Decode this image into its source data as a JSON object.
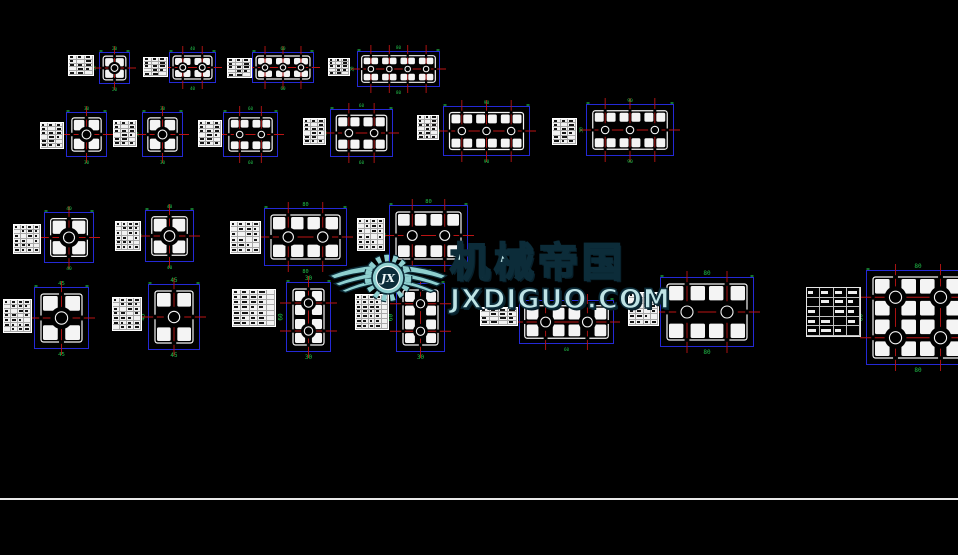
{
  "canvas": {
    "width": 958,
    "height": 555,
    "background": "#000000"
  },
  "palette": {
    "outline": "#f4f4f4",
    "dimension": "#2429d6",
    "centerline": "#bb1414",
    "annotation": "#21c04a",
    "table_bg": "#f2f2f2",
    "table_text": "#141414",
    "divider": "#e9e9e9"
  },
  "watermark": {
    "brand": "机械帝国",
    "site": "JXDIGUO.COM",
    "monogram": "JX",
    "fill": "#8ecfcf",
    "edge": "#0c2c39"
  },
  "divider": {
    "y": 498
  },
  "units": [
    {
      "name": "20x20",
      "dims": {
        "w": "20",
        "h": "20"
      },
      "table": {
        "x": 68,
        "y": 55,
        "w": 26,
        "h": 21,
        "rows": 5,
        "cols": 3
      },
      "draw": {
        "x": 99,
        "y": 52,
        "w": 31,
        "h": 32,
        "nx": 1,
        "ny": 1
      }
    },
    {
      "name": "20x40",
      "dims": {
        "w": "40",
        "h": "20"
      },
      "table": {
        "x": 143,
        "y": 57,
        "w": 25,
        "h": 20,
        "rows": 5,
        "cols": 3
      },
      "draw": {
        "x": 169,
        "y": 52,
        "w": 47,
        "h": 31,
        "nx": 2,
        "ny": 1
      }
    },
    {
      "name": "20x60",
      "dims": {
        "w": "60",
        "h": "20"
      },
      "table": {
        "x": 227,
        "y": 58,
        "w": 25,
        "h": 20,
        "rows": 5,
        "cols": 3
      },
      "draw": {
        "x": 252,
        "y": 52,
        "w": 62,
        "h": 31,
        "nx": 3,
        "ny": 1
      }
    },
    {
      "name": "20x80",
      "dims": {
        "w": "80",
        "h": "20"
      },
      "table": {
        "x": 328,
        "y": 58,
        "w": 22,
        "h": 18,
        "rows": 5,
        "cols": 3
      },
      "draw": {
        "x": 357,
        "y": 51,
        "w": 83,
        "h": 36,
        "nx": 4,
        "ny": 1
      }
    },
    {
      "name": "30x30-a",
      "dims": {
        "w": "30",
        "h": "30"
      },
      "table": {
        "x": 40,
        "y": 122,
        "w": 24,
        "h": 27,
        "rows": 6,
        "cols": 3
      },
      "draw": {
        "x": 66,
        "y": 112,
        "w": 41,
        "h": 45,
        "nx": 1,
        "ny": 1
      }
    },
    {
      "name": "30x30-b",
      "dims": {
        "w": "30",
        "h": "30"
      },
      "table": {
        "x": 113,
        "y": 120,
        "w": 24,
        "h": 27,
        "rows": 6,
        "cols": 3
      },
      "draw": {
        "x": 142,
        "y": 112,
        "w": 41,
        "h": 45,
        "nx": 1,
        "ny": 1
      }
    },
    {
      "name": "30x60-a",
      "dims": {
        "w": "60",
        "h": "30"
      },
      "table": {
        "x": 198,
        "y": 120,
        "w": 24,
        "h": 27,
        "rows": 6,
        "cols": 3
      },
      "draw": {
        "x": 223,
        "y": 112,
        "w": 55,
        "h": 45,
        "nx": 2,
        "ny": 1
      }
    },
    {
      "name": "30x60-b",
      "dims": {
        "w": "60",
        "h": "30"
      },
      "table": {
        "x": 303,
        "y": 118,
        "w": 23,
        "h": 27,
        "rows": 6,
        "cols": 3
      },
      "draw": {
        "x": 330,
        "y": 109,
        "w": 63,
        "h": 48,
        "nx": 2,
        "ny": 1
      }
    },
    {
      "name": "30x90-a",
      "dims": {
        "w": "90",
        "h": "30"
      },
      "table": {
        "x": 417,
        "y": 115,
        "w": 22,
        "h": 25,
        "rows": 6,
        "cols": 3
      },
      "draw": {
        "x": 443,
        "y": 106,
        "w": 87,
        "h": 50,
        "nx": 3,
        "ny": 1
      }
    },
    {
      "name": "30x90-b",
      "dims": {
        "w": "90",
        "h": "30"
      },
      "table": {
        "x": 552,
        "y": 118,
        "w": 25,
        "h": 27,
        "rows": 6,
        "cols": 3
      },
      "draw": {
        "x": 586,
        "y": 104,
        "w": 88,
        "h": 52,
        "nx": 3,
        "ny": 1
      }
    },
    {
      "name": "40x40-a",
      "dims": {
        "w": "40",
        "h": "40"
      },
      "table": {
        "x": 13,
        "y": 224,
        "w": 28,
        "h": 30,
        "rows": 6,
        "cols": 4
      },
      "draw": {
        "x": 44,
        "y": 212,
        "w": 50,
        "h": 51,
        "nx": 1,
        "ny": 1
      }
    },
    {
      "name": "40x40-b",
      "dims": {
        "w": "40",
        "h": "40"
      },
      "table": {
        "x": 115,
        "y": 221,
        "w": 26,
        "h": 30,
        "rows": 6,
        "cols": 4
      },
      "draw": {
        "x": 145,
        "y": 210,
        "w": 49,
        "h": 52,
        "nx": 1,
        "ny": 1
      }
    },
    {
      "name": "40x80-a",
      "dims": {
        "w": "80",
        "h": "40"
      },
      "table": {
        "x": 230,
        "y": 221,
        "w": 31,
        "h": 33,
        "rows": 6,
        "cols": 4
      },
      "draw": {
        "x": 264,
        "y": 208,
        "w": 83,
        "h": 58,
        "nx": 2,
        "ny": 1
      }
    },
    {
      "name": "40x80-b",
      "dims": {
        "w": "80",
        "h": "40"
      },
      "table": {
        "x": 357,
        "y": 218,
        "w": 28,
        "h": 33,
        "rows": 6,
        "cols": 4
      },
      "draw": {
        "x": 389,
        "y": 205,
        "w": 79,
        "h": 61,
        "nx": 2,
        "ny": 1
      }
    },
    {
      "name": "45x45-a",
      "dims": {
        "w": "45",
        "h": "45"
      },
      "table": {
        "x": 3,
        "y": 299,
        "w": 29,
        "h": 34,
        "rows": 7,
        "cols": 4
      },
      "draw": {
        "x": 34,
        "y": 287,
        "w": 55,
        "h": 62,
        "nx": 1,
        "ny": 1
      }
    },
    {
      "name": "45x45-b",
      "dims": {
        "w": "45",
        "h": "45"
      },
      "table": {
        "x": 112,
        "y": 297,
        "w": 30,
        "h": 34,
        "rows": 7,
        "cols": 4
      },
      "draw": {
        "x": 148,
        "y": 284,
        "w": 52,
        "h": 66,
        "nx": 1,
        "ny": 1
      }
    },
    {
      "name": "30x60-v-a",
      "dims": {
        "w": "30",
        "h": "60"
      },
      "table": {
        "x": 232,
        "y": 289,
        "w": 44,
        "h": 38,
        "rows": 7,
        "cols": 5
      },
      "draw": {
        "x": 286,
        "y": 282,
        "w": 45,
        "h": 70,
        "nx": 1,
        "ny": 2
      }
    },
    {
      "name": "30x60-v-b",
      "dims": {
        "w": "30",
        "h": "60"
      },
      "table": {
        "x": 355,
        "y": 294,
        "w": 34,
        "h": 36,
        "rows": 7,
        "cols": 5
      },
      "draw": {
        "x": 396,
        "y": 283,
        "w": 49,
        "h": 69,
        "nx": 1,
        "ny": 2
      }
    },
    {
      "name": "30x60-flat",
      "dims": {
        "w": "60",
        "h": "30"
      },
      "table": {
        "x": 480,
        "y": 307,
        "w": 38,
        "h": 19,
        "rows": 4,
        "cols": 4
      },
      "draw": {
        "x": 519,
        "y": 300,
        "w": 95,
        "h": 44,
        "nx": 2,
        "ny": 1
      }
    },
    {
      "name": "40x80-c",
      "dims": {
        "w": "80",
        "h": "40"
      },
      "table": {
        "x": 628,
        "y": 292,
        "w": 31,
        "h": 34,
        "rows": 6,
        "cols": 4
      },
      "draw": {
        "x": 660,
        "y": 277,
        "w": 94,
        "h": 70,
        "nx": 2,
        "ny": 1
      }
    },
    {
      "name": "80x80",
      "dims": {
        "w": "80",
        "h": "80"
      },
      "table": {
        "x": 806,
        "y": 287,
        "w": 55,
        "h": 50,
        "rows": 5,
        "cols": 4,
        "dark": true
      },
      "draw": {
        "x": 866,
        "y": 270,
        "w": 104,
        "h": 95,
        "nx": 2,
        "ny": 2
      }
    }
  ]
}
